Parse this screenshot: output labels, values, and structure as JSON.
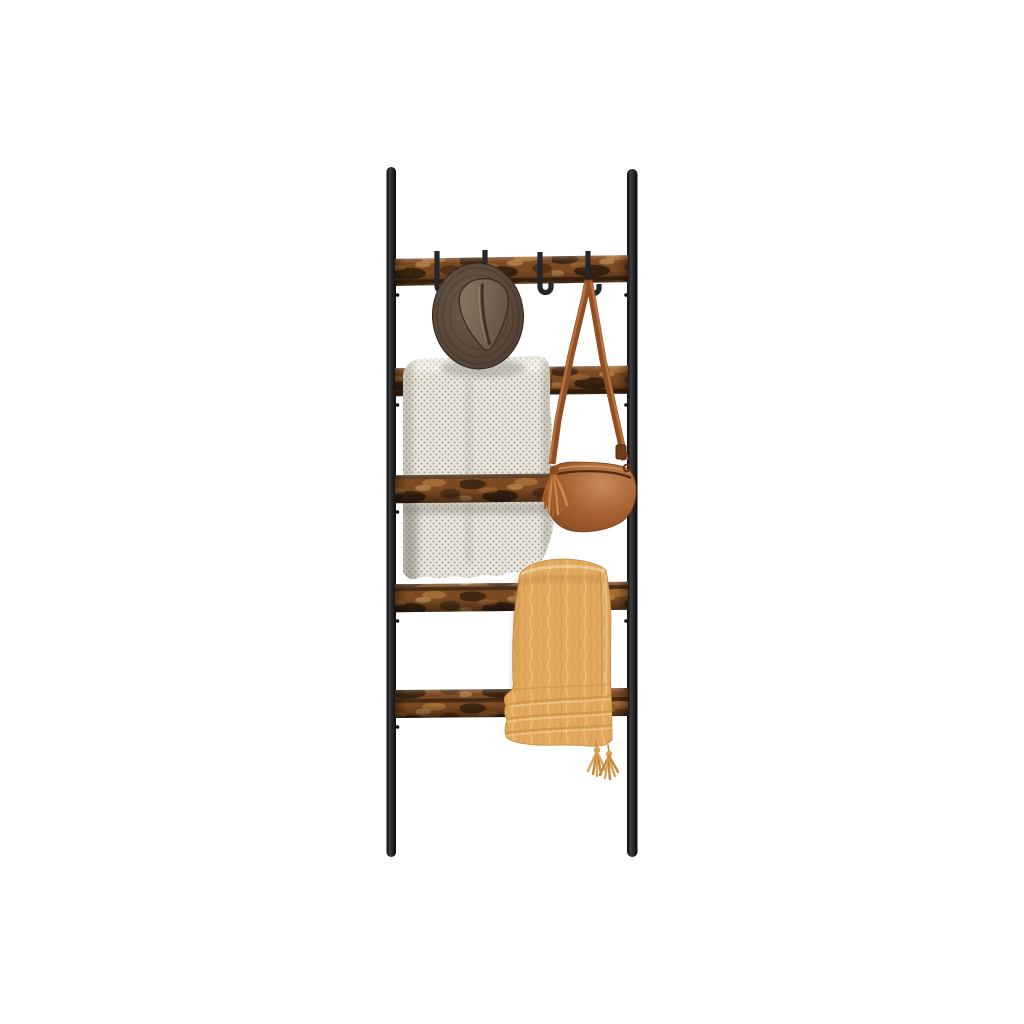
{
  "scene": {
    "type": "product-photo",
    "background": "#ffffff",
    "description": "Wall-leaning blanket ladder with five rustic wooden rungs on a black steel frame, styled with a brown fedora hat, a cream knitted blanket, a brown leather crossbody bag and a mustard muslin throw with tassels",
    "alt": "Blanket ladder product photo on white background"
  },
  "product": {
    "name": "Blanket Ladder Shelf with Hooks",
    "frame": "black steel poles",
    "rung_count": 5,
    "hook_count": 4,
    "finish": "rustic brown"
  },
  "items": [
    {
      "label": "Black steel ladder frame"
    },
    {
      "label": "Rustic brown wooden rung"
    },
    {
      "label": "Black metal hook"
    },
    {
      "label": "Brown fedora hat"
    },
    {
      "label": "Cream knitted blanket"
    },
    {
      "label": "Brown leather crossbody bag with tassel"
    },
    {
      "label": "Mustard yellow muslin throw with tassels"
    }
  ],
  "colors": {
    "background": "#ffffff",
    "pole_dark": "#0c0c0c",
    "pole_mid": "#3d3d3f",
    "wood_base": "#7c4a22",
    "wood_light": "#a96f35",
    "wood_lighter": "#c79a5e",
    "wood_dark": "#33200f",
    "wood_darkest": "#1d1208",
    "hook": "#26262a",
    "hat_edge": "#3a2e26",
    "hat_mid": "#584739",
    "hat_light": "#6f5d50",
    "crown_light": "#8d7967",
    "crown_dark": "#675547",
    "crease": "#3e3128",
    "scarf_base": "#eae6db",
    "scarf_dot": "#8f897c",
    "strap": "#904e24",
    "strap_hi": "#c47f48",
    "bag_light": "#c98a58",
    "bag_main": "#a86232",
    "bag_dark": "#7c431c",
    "zipper": "#4f2d15",
    "bag_tassel": "#a96028",
    "bag_tassel_hi": "#c18a50",
    "throw_base": "#e2a95e",
    "throw_light": "#f0c98d",
    "throw_dark": "#c8903f",
    "tassel": "#d9a255"
  }
}
